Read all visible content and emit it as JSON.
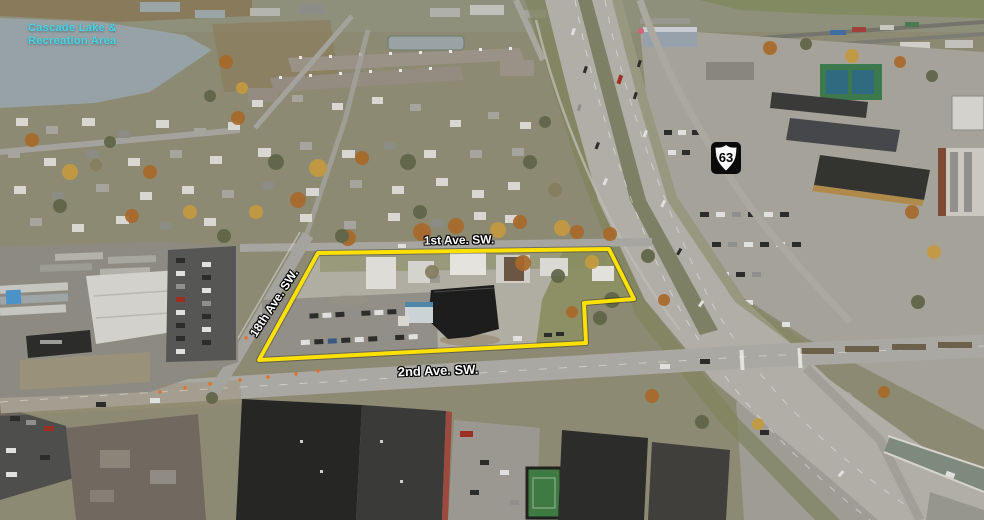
{
  "annotations": {
    "lake_label_line1": "Cascade Lake &",
    "lake_label_line2": "Recreation Area",
    "street_label_top": "1st Ave. SW.",
    "street_label_diagonal": "18th Ave. SW.",
    "street_label_bottom": "2nd Ave. SW.",
    "route_shield_number": "63"
  },
  "colors": {
    "parcel_outline": "#FFE100",
    "lake_label_text": "#45D5E5",
    "street_label_text": "#FFFFFF",
    "street_label_outline": "#000000",
    "route_shield_background": "#000000",
    "route_shield_face": "#FFFFFF",
    "route_shield_number": "#000000"
  }
}
